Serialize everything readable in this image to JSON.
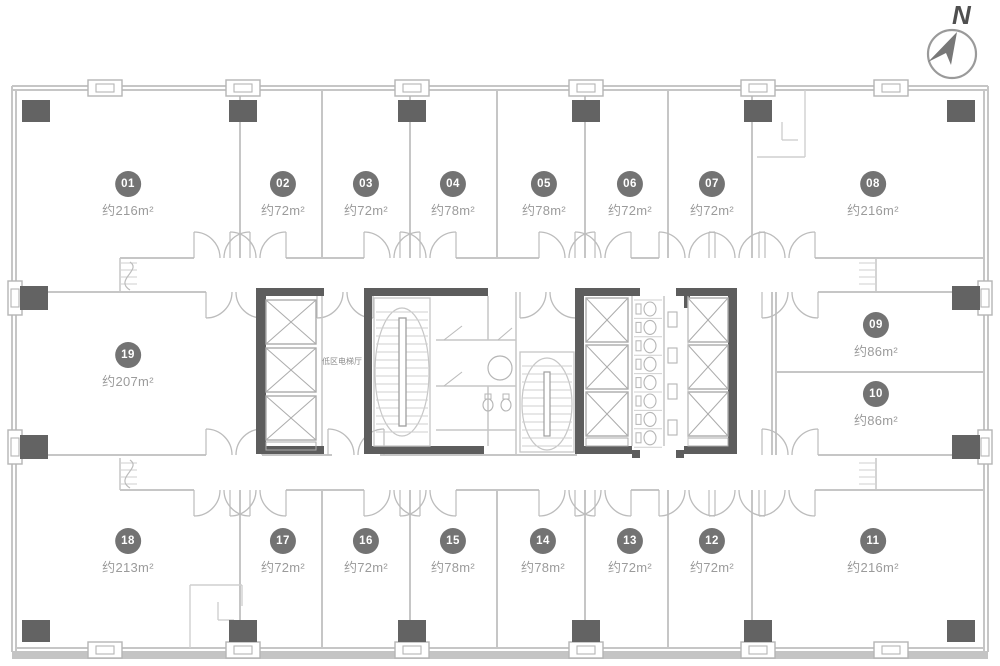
{
  "compass": {
    "north_label": "N"
  },
  "core": {
    "elevator_hall_label": "低区电梯厅"
  },
  "units": [
    {
      "id": "01",
      "area": "约216m²"
    },
    {
      "id": "02",
      "area": "约72m²"
    },
    {
      "id": "03",
      "area": "约72m²"
    },
    {
      "id": "04",
      "area": "约78m²"
    },
    {
      "id": "05",
      "area": "约78m²"
    },
    {
      "id": "06",
      "area": "约72m²"
    },
    {
      "id": "07",
      "area": "约72m²"
    },
    {
      "id": "08",
      "area": "约216m²"
    },
    {
      "id": "09",
      "area": "约86m²"
    },
    {
      "id": "10",
      "area": "约86m²"
    },
    {
      "id": "11",
      "area": "约216m²"
    },
    {
      "id": "12",
      "area": "约72m²"
    },
    {
      "id": "13",
      "area": "约72m²"
    },
    {
      "id": "14",
      "area": "约78m²"
    },
    {
      "id": "15",
      "area": "约78m²"
    },
    {
      "id": "16",
      "area": "约72m²"
    },
    {
      "id": "17",
      "area": "约72m²"
    },
    {
      "id": "18",
      "area": "约213m²"
    },
    {
      "id": "19",
      "area": "约207m²"
    }
  ]
}
